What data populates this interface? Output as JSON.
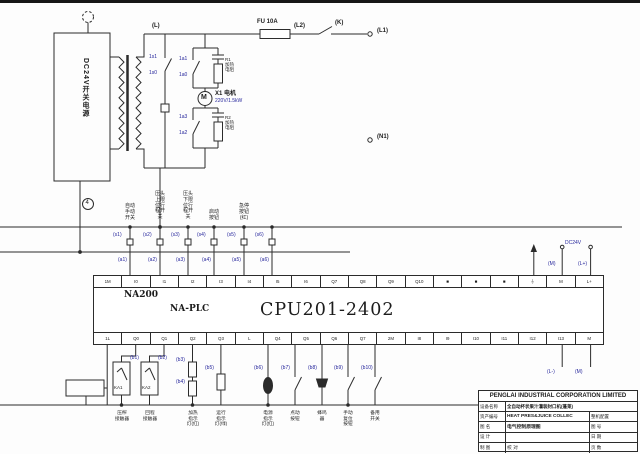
{
  "colors": {
    "accent_blue": "#26269c",
    "line": "#2b2b2b"
  },
  "power": {
    "psu": "DC24V开关电源",
    "node_l": "(L)",
    "fuse": "FU 10A",
    "node_l2": "(L2)",
    "switch_k": "(K)",
    "node_l1": "(L1)",
    "node_n1": "(N1)",
    "motor_letter": "M",
    "motor_name": "X1 电机",
    "motor_rating": "220V/1.5kW",
    "marker": "4"
  },
  "plc": {
    "series": "NA200",
    "family": "NA-PLC",
    "cpu": "CPU201-2402",
    "dc_label": "DC24V",
    "top_terminals": [
      "1M",
      "I0",
      "I1",
      "I2",
      "I3",
      "I4",
      "I5",
      "I6",
      "Q7",
      "Q8",
      "Q9",
      "Q10",
      "■",
      "■",
      "■",
      "⏚",
      "M",
      "L+"
    ],
    "bottom_terminals": [
      "1L",
      "Q0",
      "Q1",
      "Q2",
      "Q3",
      "L",
      "Q4",
      "Q5",
      "Q6",
      "Q7",
      "2M",
      "I8",
      "I9",
      "I10",
      "I11",
      "I12",
      "I13",
      "M"
    ]
  },
  "tags": [
    {
      "x": 149,
      "y": 55,
      "t": "1s1"
    },
    {
      "x": 149,
      "y": 71,
      "t": "1s0"
    },
    {
      "x": 179,
      "y": 57,
      "t": "1a1"
    },
    {
      "x": 179,
      "y": 73,
      "t": "1a0"
    },
    {
      "x": 179,
      "y": 115,
      "t": "1a3"
    },
    {
      "x": 179,
      "y": 131,
      "t": "1a2"
    },
    {
      "x": 225,
      "y": 57,
      "t": "R1\n加热\n电阻",
      "cls": "dark"
    },
    {
      "x": 225,
      "y": 115,
      "t": "R2\n加热\n电阻",
      "cls": "dark"
    },
    {
      "x": 113,
      "y": 233,
      "t": "(s1)"
    },
    {
      "x": 143,
      "y": 233,
      "t": "(s2)"
    },
    {
      "x": 171,
      "y": 233,
      "t": "(s3)"
    },
    {
      "x": 197,
      "y": 233,
      "t": "(s4)"
    },
    {
      "x": 227,
      "y": 233,
      "t": "(s5)"
    },
    {
      "x": 255,
      "y": 233,
      "t": "(s6)"
    },
    {
      "x": 118,
      "y": 258,
      "t": "(a1)"
    },
    {
      "x": 148,
      "y": 258,
      "t": "(a2)"
    },
    {
      "x": 176,
      "y": 258,
      "t": "(a3)"
    },
    {
      "x": 202,
      "y": 258,
      "t": "(a4)"
    },
    {
      "x": 232,
      "y": 258,
      "t": "(a5)"
    },
    {
      "x": 260,
      "y": 258,
      "t": "(a6)"
    },
    {
      "x": 565,
      "y": 241,
      "t": "DC24V"
    },
    {
      "x": 548,
      "y": 262,
      "t": "(M)"
    },
    {
      "x": 578,
      "y": 262,
      "t": "(L+)"
    },
    {
      "x": 130,
      "y": 356,
      "t": "(b1)"
    },
    {
      "x": 158,
      "y": 356,
      "t": "(b2)"
    },
    {
      "x": 176,
      "y": 358,
      "t": "(b3)"
    },
    {
      "x": 176,
      "y": 380,
      "t": "(b4)"
    },
    {
      "x": 205,
      "y": 366,
      "t": "(b5)"
    },
    {
      "x": 254,
      "y": 366,
      "t": "(b6)"
    },
    {
      "x": 281,
      "y": 366,
      "t": "(b7)"
    },
    {
      "x": 308,
      "y": 366,
      "t": "(b8)"
    },
    {
      "x": 334,
      "y": 366,
      "t": "(b9)"
    },
    {
      "x": 361,
      "y": 366,
      "t": "(b10)"
    },
    {
      "x": 547,
      "y": 370,
      "t": "(L-)"
    },
    {
      "x": 575,
      "y": 370,
      "t": "(M)"
    },
    {
      "x": 114,
      "y": 385,
      "t": "KA1",
      "cls": "dark"
    },
    {
      "x": 142,
      "y": 385,
      "t": "KA2",
      "cls": "dark"
    }
  ],
  "input_labels": [
    {
      "x": 121,
      "y": 204,
      "t": "自动\n手动\n开关"
    },
    {
      "x": 151,
      "y": 192,
      "t": "压头\n上限\n位行\n程开\n关"
    },
    {
      "x": 179,
      "y": 192,
      "t": "压头\n下限\n位行\n程开\n关"
    },
    {
      "x": 205,
      "y": 210,
      "t": "启动\n按钮"
    },
    {
      "x": 235,
      "y": 204,
      "t": "急停\n按钮\n(红)"
    }
  ],
  "output_labels": [
    {
      "x": 109,
      "y": 410,
      "t": "压榨\n接触器"
    },
    {
      "x": 137,
      "y": 410,
      "t": "回程\n接触器"
    },
    {
      "x": 180,
      "y": 410,
      "t": "加热\n指示\n灯(红)"
    },
    {
      "x": 208,
      "y": 410,
      "t": "运行\n指示\n灯(绿)"
    },
    {
      "x": 255,
      "y": 410,
      "t": "电源\n指示\n灯(红)"
    },
    {
      "x": 282,
      "y": 410,
      "t": "点动\n按钮"
    },
    {
      "x": 309,
      "y": 410,
      "t": "蜂鸣\n器"
    },
    {
      "x": 335,
      "y": 410,
      "t": "手动\n复位\n按钮"
    },
    {
      "x": 362,
      "y": 410,
      "t": "备用\n开关"
    }
  ],
  "titleblock": {
    "company": "PENGLAI INDUSTRIAL CORPORATION LIMITED",
    "r2_label": "设备名称",
    "r2_value": "全自动杯状果汁灌装封口机(蓬莱)",
    "r3_label": "资产编号",
    "r3_value": "HEAT PRES&JUICE COLLEC",
    "r3_extra": "整机配置",
    "r4_label": "图 名",
    "r4_value": "电气控制原理图",
    "r4_extra": "图 号",
    "r5_label": "设 计",
    "r5_value": "",
    "r5_extra": "日 期",
    "r6_label": "制 图",
    "r6_value": "校 对",
    "r6_extra": "页 数"
  }
}
